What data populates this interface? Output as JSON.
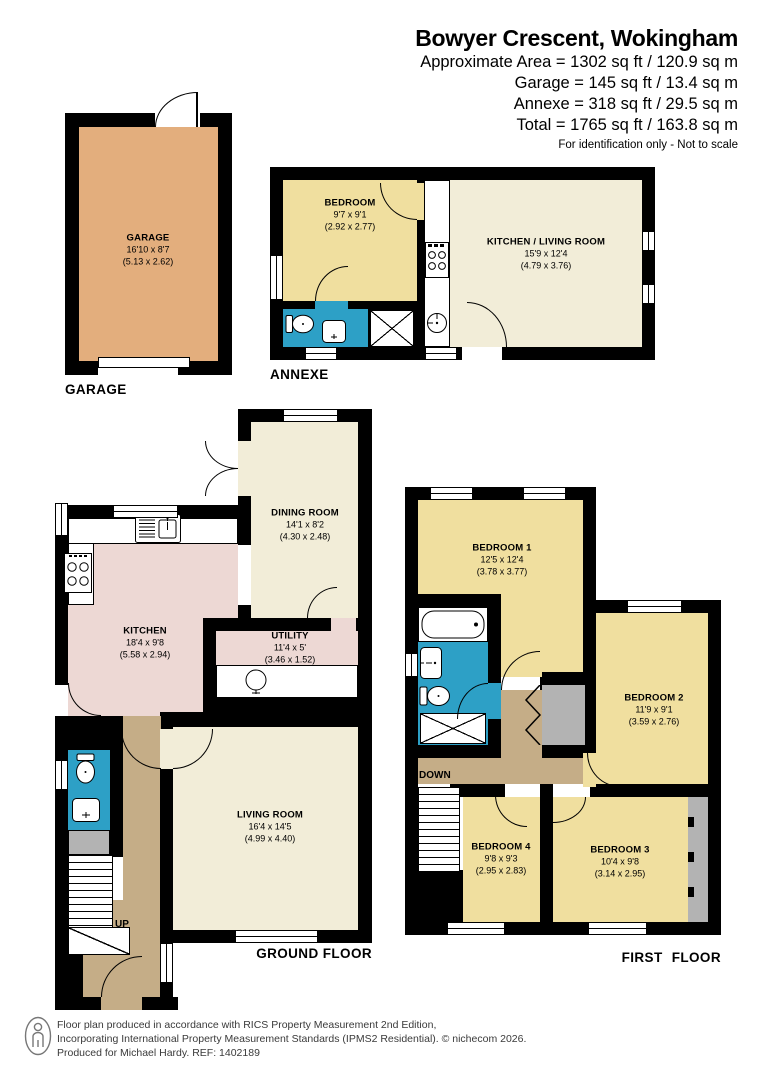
{
  "header": {
    "title": "Bowyer Crescent, Wokingham",
    "area_lines": [
      "Approximate Area = 1302 sq ft / 120.9 sq m",
      "Garage = 145 sq ft / 13.4 sq m",
      "Annexe = 318 sq ft / 29.5 sq m",
      "Total = 1765 sq ft / 163.8 sq m"
    ],
    "disclaimer": "For identification only - Not to scale"
  },
  "plans": {
    "garage": {
      "label": "GARAGE",
      "room": {
        "name": "GARAGE",
        "imperial": "16'10 x 8'7",
        "metric": "(5.13 x 2.62)"
      }
    },
    "annexe": {
      "label": "ANNEXE",
      "bedroom": {
        "name": "BEDROOM",
        "imperial": "9'7 x 9'1",
        "metric": "(2.92 x 2.77)"
      },
      "kitchen_living": {
        "name": "KITCHEN / LIVING ROOM",
        "imperial": "15'9 x 12'4",
        "metric": "(4.79 x 3.76)"
      }
    },
    "ground": {
      "label": "GROUND FLOOR",
      "up": "UP",
      "dining": {
        "name": "DINING ROOM",
        "imperial": "14'1 x 8'2",
        "metric": "(4.30 x 2.48)"
      },
      "kitchen": {
        "name": "KITCHEN",
        "imperial": "18'4 x 9'8",
        "metric": "(5.58 x 2.94)"
      },
      "utility": {
        "name": "UTILITY",
        "imperial": "11'4 x 5'",
        "metric": "(3.46 x 1.52)"
      },
      "living": {
        "name": "LIVING ROOM",
        "imperial": "16'4 x 14'5",
        "metric": "(4.99 x 4.40)"
      }
    },
    "first": {
      "label": "FIRST FLOOR",
      "down": "DOWN",
      "bedroom1": {
        "name": "BEDROOM 1",
        "imperial": "12'5 x 12'4",
        "metric": "(3.78 x 3.77)"
      },
      "bedroom2": {
        "name": "BEDROOM 2",
        "imperial": "11'9 x 9'1",
        "metric": "(3.59 x 2.76)"
      },
      "bedroom3": {
        "name": "BEDROOM 3",
        "imperial": "10'4 x 9'8",
        "metric": "(3.14 x 2.95)"
      },
      "bedroom4": {
        "name": "BEDROOM 4",
        "imperial": "9'8 x 9'3",
        "metric": "(2.95 x 2.83)"
      }
    }
  },
  "footer": {
    "lines": [
      "Floor plan produced in accordance with RICS Property Measurement 2nd Edition,",
      "Incorporating International Property Measurement Standards (IPMS2 Residential).  © nichecom 2026.",
      "Produced for Michael Hardy.   REF: 1402189"
    ]
  },
  "colors": {
    "wall": "#000000",
    "garage_floor": "#E3AE7D",
    "bedroom_yellow": "#F0DF9F",
    "living_cream": "#F2EDD8",
    "kitchen_pink": "#EDD8D4",
    "hall_tan": "#C5AD87",
    "bathroom_blue": "#2DA0C6",
    "eaves_gray": "#B3B3B3"
  }
}
